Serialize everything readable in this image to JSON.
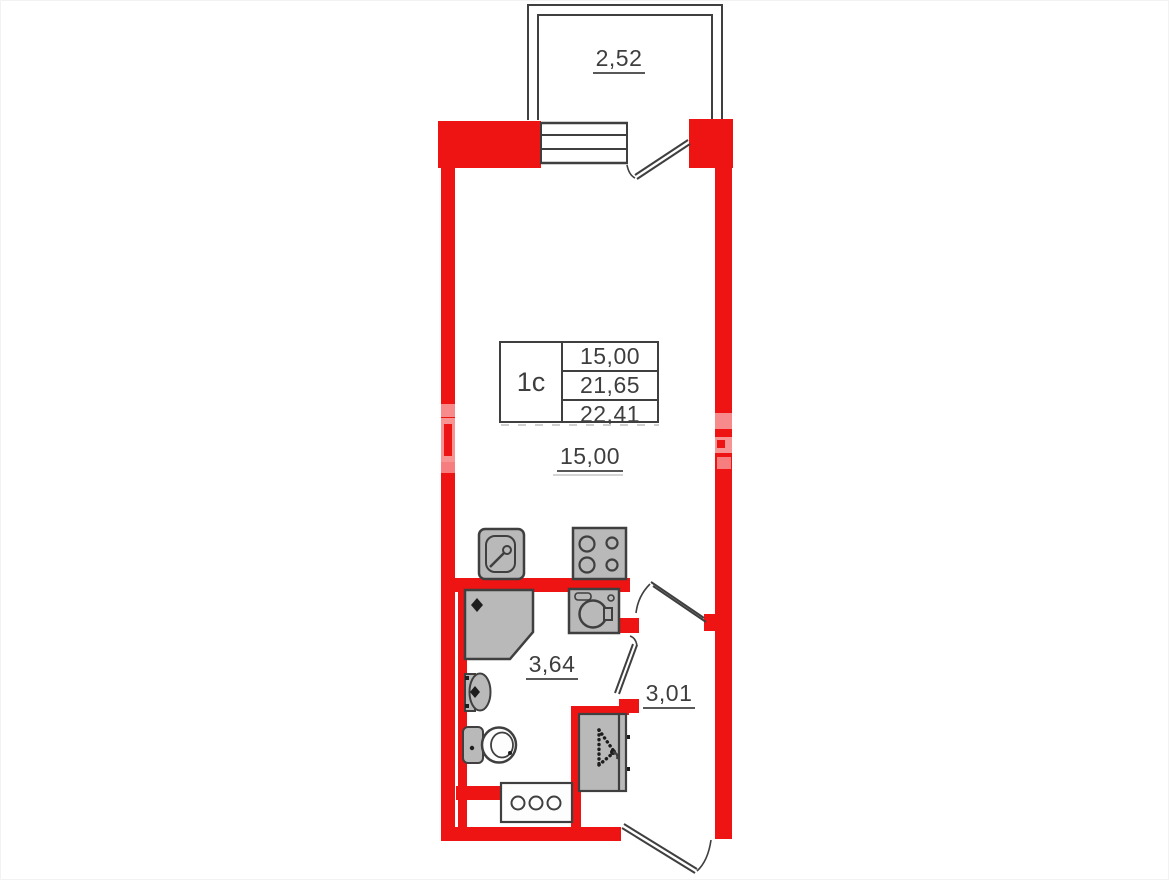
{
  "plan_info": {
    "unit_type": "1c",
    "area_rows": [
      "15,00",
      "21,65",
      "22,41"
    ]
  },
  "room_labels": {
    "balcony": "2,52",
    "living_room": "15,00",
    "bathroom": "3,64",
    "hallway": "3,01"
  },
  "colors": {
    "wall_red": "#ee1414",
    "fixture_gray": "#b9b9b9",
    "line_dark": "#3f3f3f",
    "text": "#3e3e3e"
  },
  "icons": [
    "kitchen-sink-icon",
    "stove-icon",
    "washing-machine-icon",
    "shower-cabin-icon",
    "washbasin-icon",
    "toilet-icon",
    "vent-shaft-icon",
    "wardrobe-hanger-icon",
    "window-icon",
    "door-swing-icon"
  ]
}
